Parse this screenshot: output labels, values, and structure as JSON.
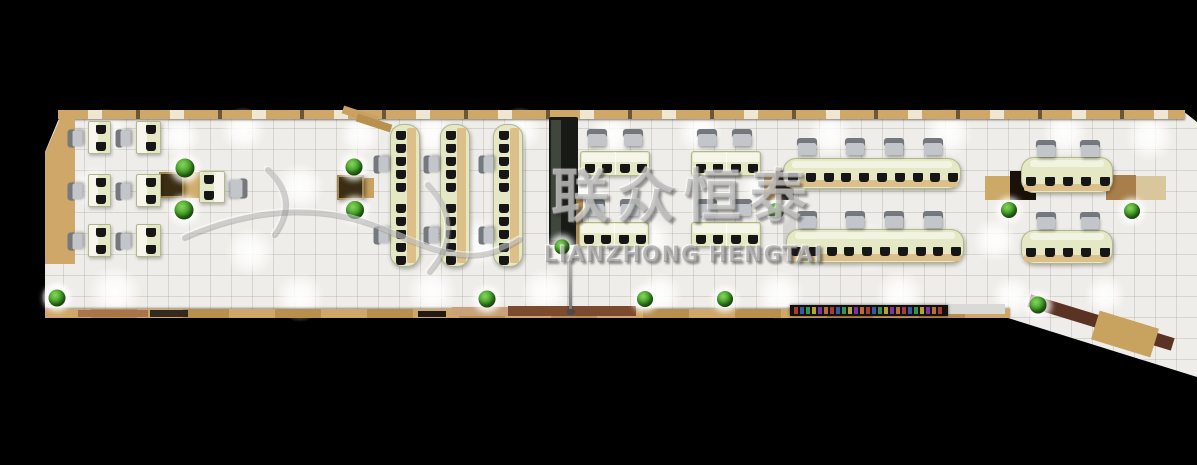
{
  "alt": "Top-down 3D rendering of a long open-plan office interior on a black background",
  "watermark": {
    "cn": "联众恒泰",
    "en": "LIANZHONG HENGTAI"
  },
  "palette": {
    "background": "#000000",
    "floor": "#efede9",
    "wood": "#cfa768",
    "wood_light": "#ddc089",
    "desk_green": "#e5e8c5",
    "desk_border": "#b2b78e",
    "chair_gray": "#c2c5c9",
    "chair_back": "#75797e",
    "monitor_dark": "#161616",
    "plant_green": "#3a9421",
    "cabinet_dark": "#1a130b",
    "table_brown": "#3a2d13",
    "watermark_gray": "#8a8a8a"
  },
  "scene": {
    "speck_colors": [
      "#b5413a",
      "#3a62b5",
      "#3aa05a",
      "#c9b43a",
      "#8a3ab5",
      "#c97a3a"
    ],
    "items": [
      {
        "t": "glow",
        "x": 105,
        "y": 133,
        "r": 26
      },
      {
        "t": "glow",
        "x": 180,
        "y": 137,
        "r": 22
      },
      {
        "t": "glow",
        "x": 243,
        "y": 130,
        "r": 24
      },
      {
        "t": "glow",
        "x": 95,
        "y": 188,
        "r": 24
      },
      {
        "t": "glow",
        "x": 300,
        "y": 187,
        "r": 26
      },
      {
        "t": "glow",
        "x": 250,
        "y": 252,
        "r": 26
      },
      {
        "t": "glow",
        "x": 115,
        "y": 292,
        "r": 28
      },
      {
        "t": "glow",
        "x": 57,
        "y": 296,
        "r": 16
      },
      {
        "t": "glow",
        "x": 300,
        "y": 297,
        "r": 26
      },
      {
        "t": "glow",
        "x": 360,
        "y": 135,
        "r": 22
      },
      {
        "t": "glow",
        "x": 432,
        "y": 135,
        "r": 24
      },
      {
        "t": "glow",
        "x": 520,
        "y": 130,
        "r": 24
      },
      {
        "t": "glow",
        "x": 480,
        "y": 242,
        "r": 26
      },
      {
        "t": "glow",
        "x": 432,
        "y": 292,
        "r": 26
      },
      {
        "t": "glow",
        "x": 545,
        "y": 292,
        "r": 26
      },
      {
        "t": "glow",
        "x": 612,
        "y": 135,
        "r": 24
      },
      {
        "t": "glow",
        "x": 700,
        "y": 132,
        "r": 24
      },
      {
        "t": "glow",
        "x": 648,
        "y": 240,
        "r": 26
      },
      {
        "t": "glow",
        "x": 660,
        "y": 295,
        "r": 24
      },
      {
        "t": "glow",
        "x": 780,
        "y": 295,
        "r": 26
      },
      {
        "t": "glow",
        "x": 585,
        "y": 187,
        "r": 20
      },
      {
        "t": "glow",
        "x": 760,
        "y": 187,
        "r": 20
      },
      {
        "t": "glow",
        "x": 830,
        "y": 135,
        "r": 24
      },
      {
        "t": "glow",
        "x": 948,
        "y": 133,
        "r": 26
      },
      {
        "t": "glow",
        "x": 870,
        "y": 247,
        "r": 26
      },
      {
        "t": "glow",
        "x": 900,
        "y": 295,
        "r": 26
      },
      {
        "t": "glow",
        "x": 995,
        "y": 240,
        "r": 24
      },
      {
        "t": "glow",
        "x": 1012,
        "y": 296,
        "r": 22
      },
      {
        "t": "glow",
        "x": 1065,
        "y": 133,
        "r": 24
      },
      {
        "t": "glow",
        "x": 1150,
        "y": 137,
        "r": 26
      },
      {
        "t": "glow",
        "x": 1090,
        "y": 247,
        "r": 26
      },
      {
        "t": "glow",
        "x": 1105,
        "y": 295,
        "r": 22
      },
      {
        "t": "rect",
        "n": "top-wall",
        "x": 58,
        "y": 110,
        "w": 1127,
        "h": 9,
        "cls": "wall-top"
      },
      {
        "t": "rect",
        "n": "top-wall-jog",
        "x": 342,
        "y": 111,
        "w": 36,
        "h": 8,
        "c": "#c9a261",
        "rot": 18
      },
      {
        "t": "rect",
        "n": "top-wall-jog",
        "x": 356,
        "y": 119,
        "w": 36,
        "h": 8,
        "c": "#b8914f",
        "rot": 18
      },
      {
        "t": "rect",
        "n": "left-wood-floor",
        "x": 45,
        "y": 114,
        "w": 30,
        "h": 150,
        "c": "#cfa768",
        "cls": "clip-diag woodgrain"
      },
      {
        "t": "rect",
        "n": "bottom-wall",
        "x": 45,
        "y": 309,
        "w": 965,
        "h": 9,
        "cls": "wall-bottom"
      },
      {
        "t": "rect",
        "n": "bottom-wall-brown",
        "x": 78,
        "y": 310,
        "w": 70,
        "h": 7,
        "c": "#a9744a"
      },
      {
        "t": "rect",
        "n": "bottom-wall-dark",
        "x": 150,
        "y": 310,
        "w": 38,
        "h": 7,
        "c": "#332a1e"
      },
      {
        "t": "rect",
        "n": "bottom-walkway-light",
        "x": 452,
        "y": 307,
        "w": 56,
        "h": 9,
        "c": "#c9a27a"
      },
      {
        "t": "rect",
        "n": "bottom-walkway-brown",
        "x": 508,
        "y": 306,
        "w": 128,
        "h": 10,
        "c": "#7c4a2e"
      },
      {
        "t": "rect",
        "n": "bottom-wall-dark",
        "x": 418,
        "y": 311,
        "w": 28,
        "h": 6,
        "c": "#211a12"
      },
      {
        "t": "rect",
        "n": "bottom-ledge-white",
        "x": 947,
        "y": 304,
        "w": 58,
        "h": 10,
        "c": "#d9dad5"
      },
      {
        "t": "colorband",
        "n": "decor-shelf-strip",
        "x": 790,
        "y": 305,
        "w": 158,
        "h": 11
      },
      {
        "t": "rect",
        "n": "diagonal-wall-brown",
        "x": 1026,
        "y": 316,
        "w": 150,
        "h": 13,
        "c": "#5a3323",
        "rot": 17
      },
      {
        "t": "rect",
        "n": "diagonal-wood-wedge",
        "x": 1094,
        "y": 319,
        "w": 62,
        "h": 30,
        "c": "#c8a35f",
        "rot": 17,
        "cls": "woodgrain"
      },
      {
        "t": "rect",
        "n": "partition-cabinet-dark",
        "x": 549,
        "y": 117,
        "w": 29,
        "h": 128,
        "c": "#181a16",
        "rad": 2
      },
      {
        "t": "rect",
        "n": "partition-glass",
        "x": 551,
        "y": 120,
        "w": 10,
        "h": 120,
        "c": "#3f463c"
      },
      {
        "t": "rect",
        "n": "partition-wood-trim",
        "x": 576,
        "y": 196,
        "w": 7,
        "h": 50,
        "c": "#b08d54"
      },
      {
        "t": "rect",
        "n": "meeting-wood-pad",
        "x": 183,
        "y": 172,
        "w": 17,
        "h": 26,
        "c": "#d2ad6e"
      },
      {
        "t": "rect",
        "n": "square-table-dark",
        "x": 159,
        "y": 172,
        "w": 25,
        "h": 26,
        "c": "#3a2d13",
        "cls": "tbl"
      },
      {
        "t": "rect",
        "n": "meeting-wood-pad",
        "x": 363,
        "y": 178,
        "w": 11,
        "h": 20,
        "c": "#c8a35f"
      },
      {
        "t": "rect",
        "n": "square-table-dark",
        "x": 337,
        "y": 175,
        "w": 27,
        "h": 25,
        "c": "#3a2d13",
        "cls": "tbl"
      },
      {
        "t": "rect",
        "n": "cabinet-wood",
        "x": 764,
        "y": 173,
        "w": 12,
        "h": 27,
        "c": "#c8a35f"
      },
      {
        "t": "rect",
        "n": "cabinet-dark",
        "x": 776,
        "y": 171,
        "w": 18,
        "h": 29,
        "c": "#1c140c"
      },
      {
        "t": "rect",
        "n": "cabinet-wood",
        "x": 985,
        "y": 176,
        "w": 25,
        "h": 24,
        "c": "#cda968"
      },
      {
        "t": "rect",
        "n": "cabinet-dark",
        "x": 1010,
        "y": 171,
        "w": 26,
        "h": 29,
        "c": "#1a120a"
      },
      {
        "t": "rect",
        "n": "cabinet-wood",
        "x": 1106,
        "y": 175,
        "w": 30,
        "h": 25,
        "c": "#a87f4a",
        "cls": "woodgrain"
      },
      {
        "t": "rect",
        "n": "cabinet-wood-light",
        "x": 1136,
        "y": 176,
        "w": 30,
        "h": 24,
        "c": "#d9c69c"
      },
      {
        "t": "rect",
        "n": "coat-rack",
        "x": 783,
        "y": 212,
        "w": 13,
        "h": 52,
        "c": "rgba(140,140,140,0.25)",
        "rad": 6
      },
      {
        "t": "deskv",
        "x": 88,
        "y": 121,
        "w": 23,
        "h": 33,
        "m": 2
      },
      {
        "t": "deskv",
        "x": 136,
        "y": 121,
        "w": 25,
        "h": 33,
        "m": 2
      },
      {
        "t": "deskv",
        "x": 88,
        "y": 174,
        "w": 23,
        "h": 33,
        "m": 2
      },
      {
        "t": "deskv",
        "x": 136,
        "y": 174,
        "w": 25,
        "h": 33,
        "m": 2
      },
      {
        "t": "deskv",
        "x": 88,
        "y": 224,
        "w": 23,
        "h": 33,
        "m": 2
      },
      {
        "t": "deskv",
        "x": 136,
        "y": 224,
        "w": 25,
        "h": 33,
        "m": 2
      },
      {
        "t": "deskv",
        "n": "manager-double-desk",
        "x": 199,
        "y": 171,
        "w": 26,
        "h": 32,
        "m": 2,
        "mir": true
      },
      {
        "t": "benchv",
        "x": 390,
        "y": 124,
        "w": 30,
        "h": 143,
        "m": 10
      },
      {
        "t": "benchv",
        "x": 440,
        "y": 124,
        "w": 30,
        "h": 143,
        "m": 10
      },
      {
        "t": "benchv",
        "x": 493,
        "y": 124,
        "w": 30,
        "h": 143,
        "m": 10
      },
      {
        "t": "pod",
        "x": 580,
        "y": 151,
        "w": 70,
        "h": 25,
        "m": 4
      },
      {
        "t": "pod",
        "x": 691,
        "y": 151,
        "w": 70,
        "h": 25,
        "m": 4
      },
      {
        "t": "pod",
        "x": 579,
        "y": 222,
        "w": 70,
        "h": 25,
        "m": 4
      },
      {
        "t": "pod",
        "x": 691,
        "y": 222,
        "w": 70,
        "h": 25,
        "m": 4
      },
      {
        "t": "benchh",
        "x": 783,
        "y": 158,
        "w": 178,
        "h": 31,
        "m": 10
      },
      {
        "t": "benchh",
        "x": 786,
        "y": 229,
        "w": 178,
        "h": 34,
        "m": 10
      },
      {
        "t": "benchh",
        "x": 1021,
        "y": 157,
        "w": 92,
        "h": 36,
        "m": 5
      },
      {
        "t": "benchh",
        "x": 1021,
        "y": 230,
        "w": 92,
        "h": 34,
        "m": 5
      },
      {
        "t": "chair",
        "x": 66,
        "y": 131,
        "rot": 270
      },
      {
        "t": "chair",
        "x": 114,
        "y": 131,
        "rot": 270
      },
      {
        "t": "chair",
        "x": 66,
        "y": 184,
        "rot": 270
      },
      {
        "t": "chair",
        "x": 114,
        "y": 184,
        "rot": 270
      },
      {
        "t": "chair",
        "x": 66,
        "y": 234,
        "rot": 270
      },
      {
        "t": "chair",
        "x": 114,
        "y": 234,
        "rot": 270
      },
      {
        "t": "chair",
        "x": 229,
        "y": 180,
        "w": 20,
        "h": 17,
        "rot": 90
      },
      {
        "t": "chair",
        "x": 372,
        "y": 157,
        "rot": 270
      },
      {
        "t": "chair",
        "x": 372,
        "y": 228,
        "rot": 270
      },
      {
        "t": "chair",
        "x": 422,
        "y": 157,
        "rot": 270
      },
      {
        "t": "chair",
        "x": 422,
        "y": 228,
        "rot": 270
      },
      {
        "t": "chair",
        "x": 477,
        "y": 157,
        "rot": 270
      },
      {
        "t": "chair",
        "x": 477,
        "y": 228,
        "rot": 270
      },
      {
        "t": "chair",
        "x": 587,
        "y": 129,
        "w": 20,
        "h": 17
      },
      {
        "t": "chair",
        "x": 623,
        "y": 129,
        "w": 20,
        "h": 17
      },
      {
        "t": "chair",
        "x": 697,
        "y": 129,
        "w": 20,
        "h": 17
      },
      {
        "t": "chair",
        "x": 732,
        "y": 129,
        "w": 20,
        "h": 17
      },
      {
        "t": "chair",
        "x": 585,
        "y": 199,
        "w": 20,
        "h": 17
      },
      {
        "t": "chair",
        "x": 620,
        "y": 199,
        "w": 20,
        "h": 17
      },
      {
        "t": "chair",
        "x": 697,
        "y": 199,
        "w": 20,
        "h": 17
      },
      {
        "t": "chair",
        "x": 732,
        "y": 199,
        "w": 20,
        "h": 17
      },
      {
        "t": "chair",
        "x": 797,
        "y": 138,
        "w": 20,
        "h": 17
      },
      {
        "t": "chair",
        "x": 845,
        "y": 138,
        "w": 20,
        "h": 17
      },
      {
        "t": "chair",
        "x": 884,
        "y": 138,
        "w": 20,
        "h": 17
      },
      {
        "t": "chair",
        "x": 923,
        "y": 138,
        "w": 20,
        "h": 17
      },
      {
        "t": "chair",
        "x": 797,
        "y": 211,
        "w": 20,
        "h": 17
      },
      {
        "t": "chair",
        "x": 845,
        "y": 211,
        "w": 20,
        "h": 17
      },
      {
        "t": "chair",
        "x": 884,
        "y": 211,
        "w": 20,
        "h": 17
      },
      {
        "t": "chair",
        "x": 923,
        "y": 211,
        "w": 20,
        "h": 17
      },
      {
        "t": "chair",
        "x": 1036,
        "y": 140,
        "w": 20,
        "h": 17
      },
      {
        "t": "chair",
        "x": 1080,
        "y": 140,
        "w": 20,
        "h": 17
      },
      {
        "t": "chair",
        "x": 1036,
        "y": 212,
        "w": 20,
        "h": 17
      },
      {
        "t": "chair",
        "x": 1080,
        "y": 212,
        "w": 20,
        "h": 17
      },
      {
        "t": "pole",
        "n": "floor-lamp",
        "x": 569,
        "y": 256,
        "w": 3,
        "h": 56
      },
      {
        "t": "plant",
        "x": 185,
        "y": 168,
        "s": 19
      },
      {
        "t": "plant",
        "x": 184,
        "y": 210,
        "s": 19
      },
      {
        "t": "plant",
        "x": 57,
        "y": 298,
        "s": 17
      },
      {
        "t": "plant",
        "x": 354,
        "y": 167,
        "s": 17
      },
      {
        "t": "plant",
        "x": 355,
        "y": 210,
        "s": 18
      },
      {
        "t": "plant",
        "x": 487,
        "y": 299,
        "s": 17
      },
      {
        "t": "plant",
        "x": 562,
        "y": 247,
        "s": 15
      },
      {
        "t": "plant",
        "x": 776,
        "y": 211,
        "s": 16
      },
      {
        "t": "plant",
        "x": 645,
        "y": 299,
        "s": 16
      },
      {
        "t": "plant",
        "x": 725,
        "y": 299,
        "s": 16
      },
      {
        "t": "plant",
        "x": 1009,
        "y": 210,
        "s": 16
      },
      {
        "t": "plant",
        "x": 1038,
        "y": 305,
        "s": 17
      },
      {
        "t": "plant",
        "x": 1132,
        "y": 211,
        "s": 16
      }
    ]
  }
}
